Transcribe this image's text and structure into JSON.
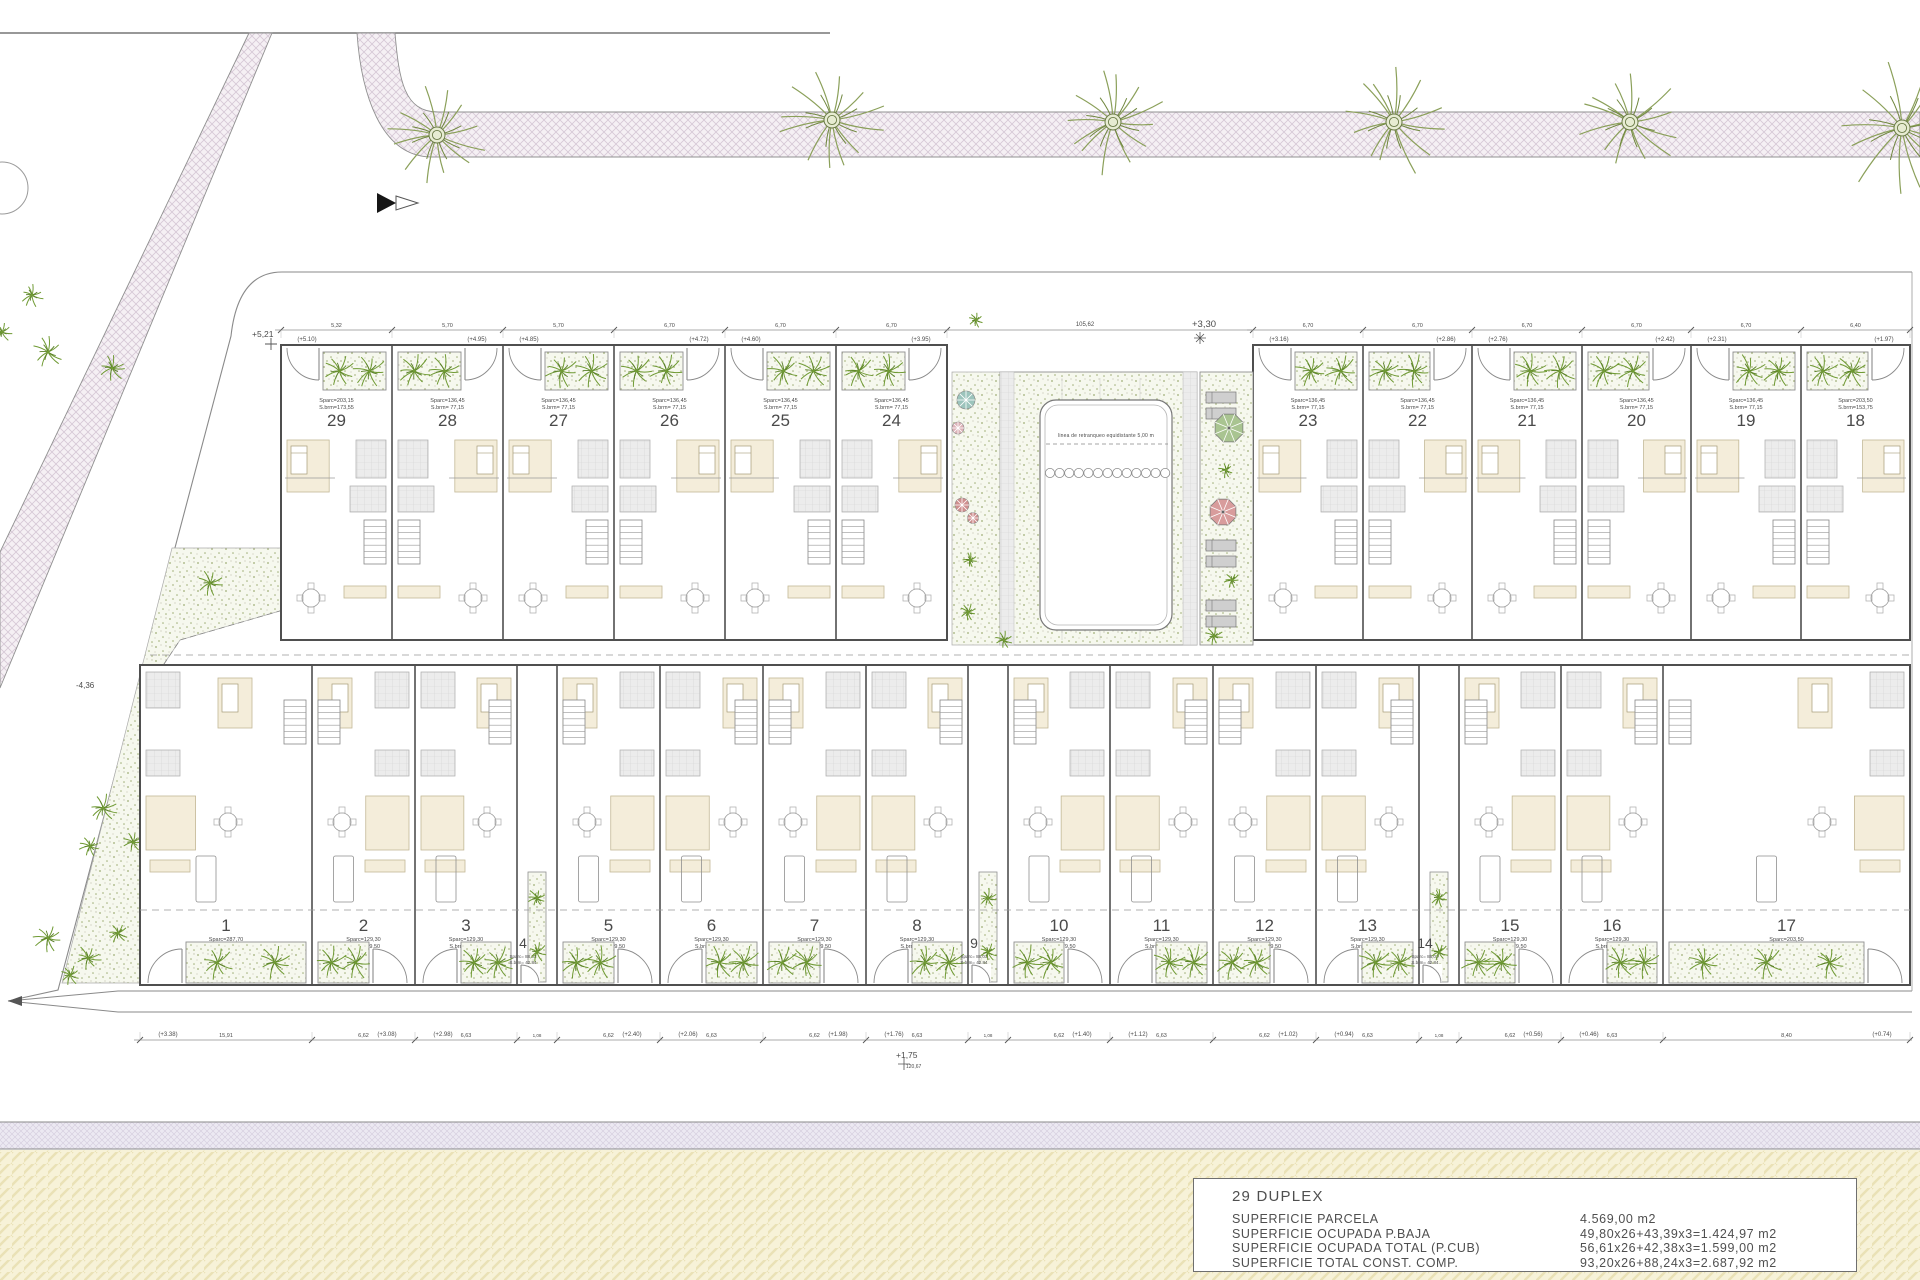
{
  "title_block": {
    "project": "29 DUPLEX",
    "rows": [
      {
        "label": "SUPERFICIE PARCELA",
        "value": "4.569,00 m2"
      },
      {
        "label": "SUPERFICIE OCUPADA P.BAJA",
        "value": "49,80x26+43,39x3=1.424,97 m2"
      },
      {
        "label": "SUPERFICIE OCUPADA TOTAL (P.CUB)",
        "value": "56,61x26+42,38x3=1.599,00 m2"
      },
      {
        "label": "SUPERFICIE TOTAL CONST. COMP.",
        "value": "93,20x26+88,24x3=2.687,92 m2"
      }
    ]
  },
  "annotations": {
    "pool_note": "linea de retranqueo equidistante 5,00 m",
    "mark_top_left": "+5,21",
    "mark_top_mid": "+3,30",
    "dim_top_total": "105,62",
    "mark_left": "-4,36",
    "mark_bottom": "+1,75",
    "dim_bottom_total": "120,67"
  },
  "units_top_left": [
    {
      "no": "29",
      "a1": "Sparc=203,15",
      "a2": "S.brm=173,55",
      "lvl": "(+5.10)"
    },
    {
      "no": "28",
      "a1": "Sparc=136,45",
      "a2": "S.brm= 77,15",
      "lvl": "(+4.95)"
    },
    {
      "no": "27",
      "a1": "Sparc=136,45",
      "a2": "S.brm= 77,15",
      "lvl": "(+4.85)"
    },
    {
      "no": "26",
      "a1": "Sparc=136,45",
      "a2": "S.brm= 77,15",
      "lvl": "(+4.72)"
    },
    {
      "no": "25",
      "a1": "Sparc=136,45",
      "a2": "S.brm= 77,15",
      "lvl": "(+4.60)"
    },
    {
      "no": "24",
      "a1": "Sparc=136,45",
      "a2": "S.brm= 77,15",
      "lvl": "(+3.95)"
    }
  ],
  "units_top_right": [
    {
      "no": "23",
      "a1": "Sparc=136,45",
      "a2": "S.brm= 77,15",
      "lvl": "(+3.16)"
    },
    {
      "no": "22",
      "a1": "Sparc=136,45",
      "a2": "S.brm= 77,15",
      "lvl": "(+2.86)"
    },
    {
      "no": "21",
      "a1": "Sparc=136,45",
      "a2": "S.brm= 77,15",
      "lvl": "(+2.76)"
    },
    {
      "no": "20",
      "a1": "Sparc=136,45",
      "a2": "S.brm= 77,15",
      "lvl": "(+2.42)"
    },
    {
      "no": "19",
      "a1": "Sparc=136,45",
      "a2": "S.brm= 77,15",
      "lvl": "(+2.31)"
    },
    {
      "no": "18",
      "a1": "Sparc=203,50",
      "a2": "S.brm=153,75",
      "lvl": "(+1.97)"
    }
  ],
  "units_bottom": [
    {
      "no": "1",
      "a1": "Sparc=287,70",
      "a2": "S.brm=237,90",
      "lvl": "(+3.38)",
      "type": "wide"
    },
    {
      "no": "2",
      "a1": "Sparc=129,30",
      "a2": "S.brm= 79,50",
      "lvl": "(+3.08)",
      "type": "t"
    },
    {
      "no": "3",
      "a1": "Sparc=129,30",
      "a2": "S.brm= 79,50",
      "lvl": "(+2.98)",
      "type": "t"
    },
    {
      "no": "4",
      "a1": "Sparc= 88,03",
      "a2": "S.brm= 42,84",
      "lvl": "(+2.71)",
      "type": "small"
    },
    {
      "no": "5",
      "a1": "Sparc=129,30",
      "a2": "S.brm= 79,50",
      "lvl": "(+2.40)",
      "type": "t"
    },
    {
      "no": "6",
      "a1": "Sparc=129,30",
      "a2": "S.brm= 79,50",
      "lvl": "(+2.06)",
      "type": "t"
    },
    {
      "no": "7",
      "a1": "Sparc=129,30",
      "a2": "S.brm= 79,50",
      "lvl": "(+1.98)",
      "type": "t"
    },
    {
      "no": "8",
      "a1": "Sparc=129,30",
      "a2": "S.brm= 79,50",
      "lvl": "(+1.76)",
      "type": "t"
    },
    {
      "no": "9",
      "a1": "Sparc= 88,03",
      "a2": "S.brm= 42,84",
      "lvl": "(+1.52)",
      "type": "small"
    },
    {
      "no": "10",
      "a1": "Sparc=129,30",
      "a2": "S.brm= 79,50",
      "lvl": "(+1.40)",
      "type": "t"
    },
    {
      "no": "11",
      "a1": "Sparc=129,30",
      "a2": "S.brm= 79,50",
      "lvl": "(+1.12)",
      "type": "t"
    },
    {
      "no": "12",
      "a1": "Sparc=129,30",
      "a2": "S.brm= 79,50",
      "lvl": "(+1.02)",
      "type": "t"
    },
    {
      "no": "13",
      "a1": "Sparc=129,30",
      "a2": "S.brm= 79,50",
      "lvl": "(+0.94)",
      "type": "t"
    },
    {
      "no": "14",
      "a1": "Sparc= 88,03",
      "a2": "S.brm= 42,84",
      "lvl": "(+0.84)",
      "type": "small"
    },
    {
      "no": "15",
      "a1": "Sparc=129,30",
      "a2": "S.brm= 79,50",
      "lvl": "(+0.56)",
      "type": "t"
    },
    {
      "no": "16",
      "a1": "Sparc=129,30",
      "a2": "S.brm= 79,50",
      "lvl": "(+0.46)",
      "type": "t"
    },
    {
      "no": "17",
      "a1": "Sparc=203,50",
      "a2": "S.brm=153,75",
      "lvl": "(+0.74)",
      "type": "wide"
    }
  ],
  "dims_top": [
    "5,32",
    "5,70",
    "5,70",
    "6,70",
    "6,70",
    "6,70",
    "6,70",
    "6,70",
    "6,70",
    "6,70",
    "6,70",
    "6,40"
  ],
  "dims_bottom": [
    "15,91",
    "6,62",
    "6,63",
    "1,08",
    "6,62",
    "6,63",
    "6,62",
    "6,63",
    "1,08",
    "6,62",
    "6,63",
    "6,62",
    "6,63",
    "1,08",
    "6,62",
    "6,63",
    "8,40"
  ],
  "colors": {
    "road_bg": "#f5f0f4",
    "road_line": "#d6c8d6",
    "stipple_bg": "#f6f8ee",
    "dot_green": "#9fae76",
    "palm": "#6f9a33",
    "palm_dark": "#597f28",
    "palm_big": "#8ba05a",
    "beige": "#f4edda",
    "beige_line": "#c3b896",
    "tile_bg": "#ececec",
    "tile_line": "#d4d4d4",
    "lavender_bg": "#ece9f2",
    "lavender_line": "#d6d0e0",
    "yellow_bg": "#f7f2d8",
    "yellow_line": "#eae1b6",
    "wall": "#4f4f4f",
    "thin": "#9a9a9a",
    "umbrella_green": "#a9c491",
    "umbrella_red": "#d89c9c",
    "flower_teal": "#9cc4bc",
    "flower_pink": "#dcb2b8",
    "flower_red": "#cf8f8f",
    "lounger": "#cfcfcf"
  }
}
